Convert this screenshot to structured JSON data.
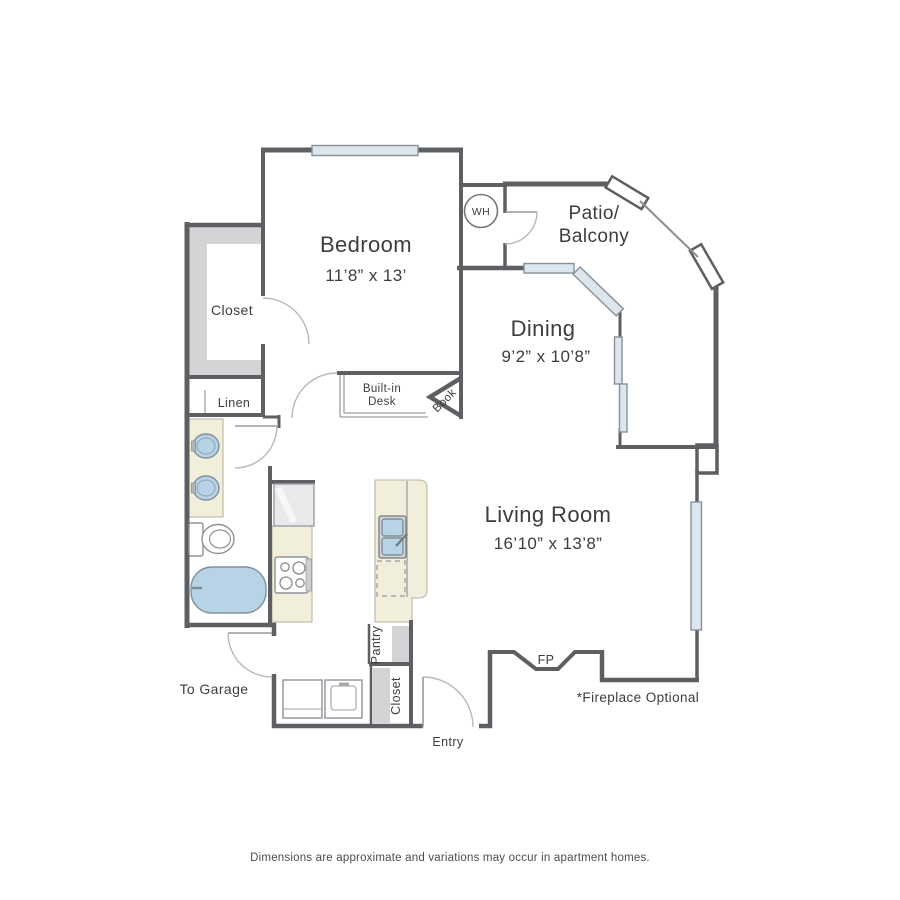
{
  "plan": {
    "rooms": {
      "bedroom": {
        "name": "Bedroom",
        "dims": "11’8” x 13’"
      },
      "dining": {
        "name": "Dining",
        "dims": "9’2” x 10’8”"
      },
      "living_room": {
        "name": "Living Room",
        "dims": "16’10” x 13’8”"
      },
      "patio": {
        "line1": "Patio/",
        "line2": "Balcony"
      }
    },
    "labels": {
      "walk_in_closet": "Closet",
      "linen": "Linen",
      "water_heater": "WH",
      "desk_line1": "Built-in",
      "desk_line2": "Desk",
      "book": "Book",
      "pantry": "Pantry",
      "entry_closet": "Closet",
      "to_garage": "To Garage",
      "entry": "Entry",
      "fireplace": "FP",
      "fireplace_note": "*Fireplace Optional"
    },
    "footer": {
      "disclaimer": "Dimensions are approximate and variations may occur in apartment homes."
    },
    "colors": {
      "wall": "#5d5f62",
      "window_fill": "#dce6ef",
      "counter_cream": "#f1efdc",
      "fixture_blue": "#b9d3e6",
      "shelf_gray": "#d3d4d6"
    }
  }
}
